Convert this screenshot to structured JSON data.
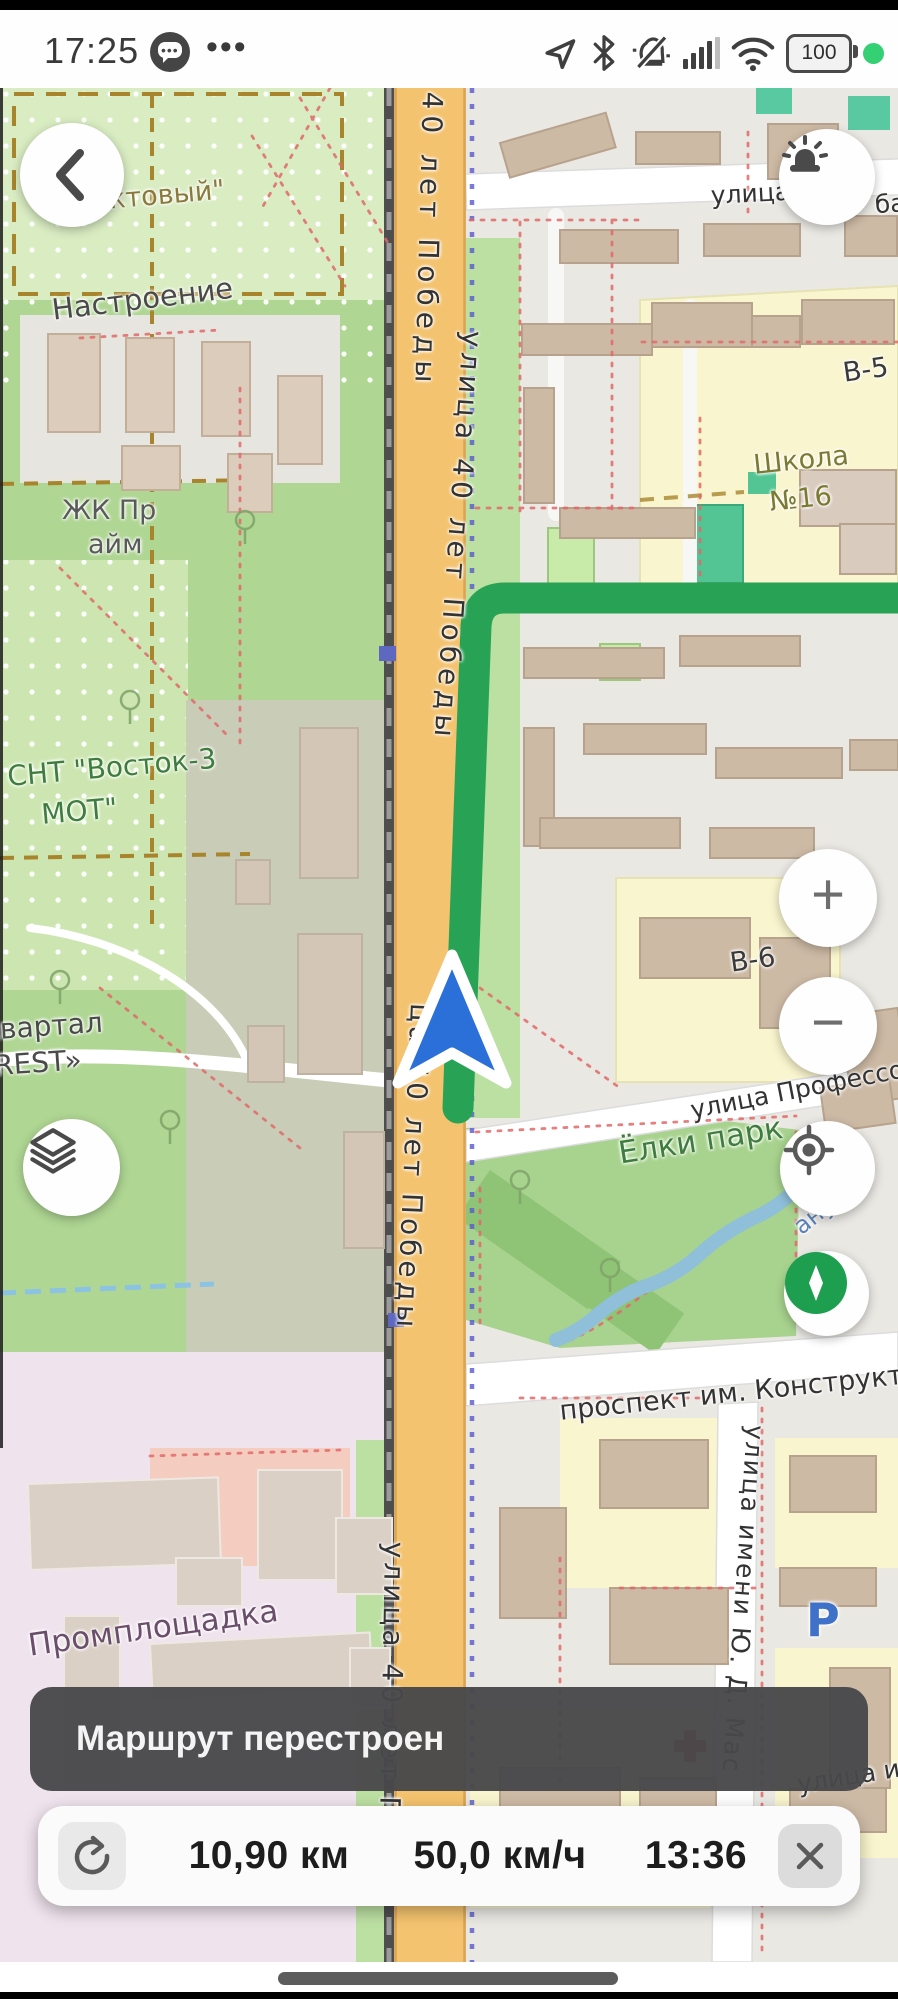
{
  "status_bar": {
    "time": "17:25",
    "more": "•••",
    "battery_level": "100"
  },
  "map": {
    "route_color": "#28A355",
    "labels": [
      {
        "text": "уктовый\""
      },
      {
        "text": "Настроение"
      },
      {
        "text": "ЖК Пр"
      },
      {
        "text": "айм"
      },
      {
        "text": "СНТ \"Восток-3"
      },
      {
        "text": "МОТ\""
      },
      {
        "text": "квартал"
      },
      {
        "text": "FOREST»"
      },
      {
        "text": "Промплощадка"
      },
      {
        "text": "40 лет Победы"
      },
      {
        "text": "улица 40 лет Победы"
      },
      {
        "text": "ца 40 лет Победы"
      },
      {
        "text": "улица 40 лет П"
      },
      {
        "text": "Школа"
      },
      {
        "text": "№16"
      },
      {
        "text": "В-5"
      },
      {
        "text": "В-6"
      },
      {
        "text": "улица Профессора Н"
      },
      {
        "text": "Ёлки парк"
      },
      {
        "text": "анушко"
      },
      {
        "text": "проспект им. Конструктора"
      },
      {
        "text": "улица имени Ю. Д. Мас"
      },
      {
        "text": "улица им"
      },
      {
        "text": "улица"
      },
      {
        "text": "ба"
      },
      {
        "text": "P"
      }
    ]
  },
  "buttons": {
    "zoom_in": "+",
    "zoom_out": "−"
  },
  "toast": {
    "message": "Маршрут перестроен"
  },
  "route_panel": {
    "distance": "10,90 км",
    "speed": "50,0 км/ч",
    "arrival_time": "13:36"
  }
}
